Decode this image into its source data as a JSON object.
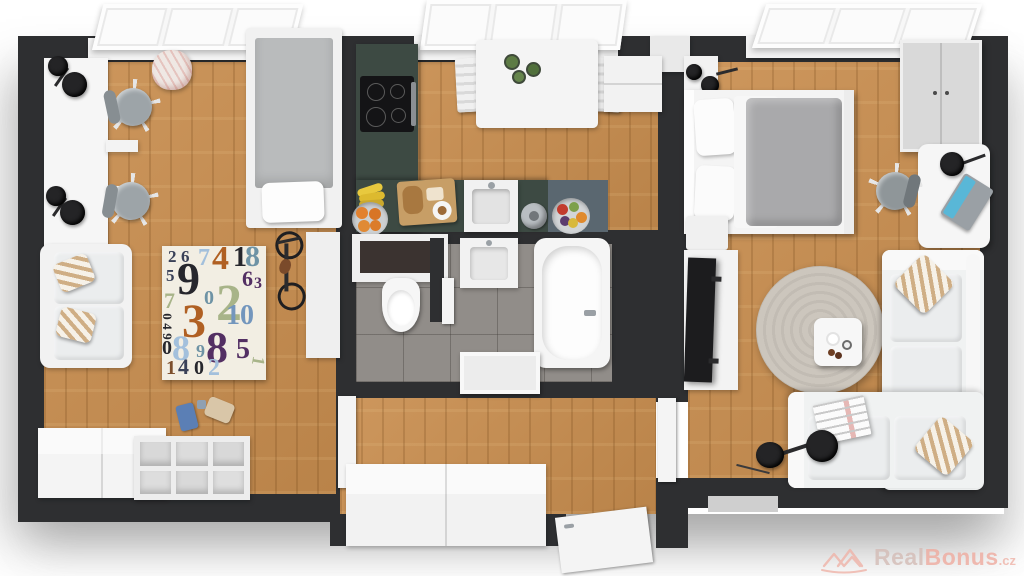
{
  "watermark": {
    "real": "Real",
    "bonus": "Bonus",
    "tld": ".cz",
    "icon": "houses-icon",
    "color_real": "#d4bcb6",
    "color_bonus": "#efab9f"
  },
  "palette": {
    "wall": "#2e2f31",
    "wood": "#c98e4f",
    "tile": "#918d89",
    "white_furniture": "#f3f3f3",
    "counter_green": "#3d4a43",
    "counter_slate": "#5a6770",
    "blanket_gray": "#a9a9ab",
    "round_rug": "#ccc6bd",
    "rugbg": "#f2eee3",
    "cooktop_black": "#141416",
    "laptop_screen": "#59b7d7",
    "orange_fruit": "#e2812f",
    "banana_yellow": "#e8c93e"
  },
  "rug": {
    "colors": {
      "navy": "#3a4158",
      "ink": "#26262c",
      "lblue": "#a3c0dc",
      "orange": "#b06023",
      "steel": "#6e93a5",
      "purple": "#532f63",
      "sage": "#a8b489",
      "blue": "#7396bd",
      "brown": "#7d4f2c"
    },
    "digits": [
      {
        "c": "2",
        "k": "navy",
        "s": 17,
        "x": 6,
        "y": 2,
        "r": 0
      },
      {
        "c": "6",
        "k": "navy",
        "s": 17,
        "x": 19,
        "y": 2,
        "r": 0
      },
      {
        "c": "7",
        "k": "lblue",
        "s": 24,
        "x": 36,
        "y": 0,
        "r": 0
      },
      {
        "c": "4",
        "k": "orange",
        "s": 34,
        "x": 50,
        "y": -4,
        "r": 0
      },
      {
        "c": "1",
        "k": "ink",
        "s": 28,
        "x": 71,
        "y": -2,
        "r": 0
      },
      {
        "c": "8",
        "k": "steel",
        "s": 30,
        "x": 83,
        "y": -4,
        "r": 0
      },
      {
        "c": "5",
        "k": "navy",
        "s": 17,
        "x": 4,
        "y": 21,
        "r": 0
      },
      {
        "c": "9",
        "k": "ink",
        "s": 46,
        "x": 15,
        "y": 10,
        "r": 0
      },
      {
        "c": "6",
        "k": "purple",
        "s": 22,
        "x": 80,
        "y": 22,
        "r": 0
      },
      {
        "c": "3",
        "k": "purple",
        "s": 16,
        "x": 92,
        "y": 30,
        "r": 0
      },
      {
        "c": "7",
        "k": "sage",
        "s": 22,
        "x": 2,
        "y": 44,
        "r": 0
      },
      {
        "c": "0",
        "k": "steel",
        "s": 20,
        "x": 42,
        "y": 42,
        "r": 0
      },
      {
        "c": "2",
        "k": "sage",
        "s": 52,
        "x": 54,
        "y": 32,
        "r": 0
      },
      {
        "c": "0",
        "k": "ink",
        "s": 13,
        "x": 2,
        "y": 64,
        "r": 90
      },
      {
        "c": "4",
        "k": "ink",
        "s": 13,
        "x": 2,
        "y": 74,
        "r": 90
      },
      {
        "c": "9",
        "k": "ink",
        "s": 13,
        "x": 2,
        "y": 84,
        "r": 90
      },
      {
        "c": "3",
        "k": "orange",
        "s": 48,
        "x": 20,
        "y": 52,
        "r": 0
      },
      {
        "c": "1",
        "k": "blue",
        "s": 28,
        "x": 64,
        "y": 56,
        "r": 0
      },
      {
        "c": "0",
        "k": "blue",
        "s": 28,
        "x": 78,
        "y": 56,
        "r": 0
      },
      {
        "c": "0",
        "k": "ink",
        "s": 20,
        "x": 0,
        "y": 92,
        "r": 0
      },
      {
        "c": "8",
        "k": "lblue",
        "s": 36,
        "x": 10,
        "y": 84,
        "r": 0
      },
      {
        "c": "9",
        "k": "steel",
        "s": 18,
        "x": 34,
        "y": 96,
        "r": 0
      },
      {
        "c": "8",
        "k": "purple",
        "s": 44,
        "x": 44,
        "y": 80,
        "r": 0
      },
      {
        "c": "5",
        "k": "purple",
        "s": 28,
        "x": 74,
        "y": 90,
        "r": 0
      },
      {
        "c": "1",
        "k": "brown",
        "s": 20,
        "x": 4,
        "y": 112,
        "r": 0
      },
      {
        "c": "4",
        "k": "navy",
        "s": 22,
        "x": 16,
        "y": 110,
        "r": 0
      },
      {
        "c": "0",
        "k": "ink",
        "s": 20,
        "x": 32,
        "y": 112,
        "r": 0
      },
      {
        "c": "2",
        "k": "lblue",
        "s": 24,
        "x": 46,
        "y": 110,
        "r": 0
      },
      {
        "c": "1",
        "k": "sage",
        "s": 18,
        "x": 92,
        "y": 106,
        "r": 100
      }
    ]
  },
  "scene": {
    "type": "3d-floor-plan-render",
    "rooms": [
      {
        "name": "kids-room-office",
        "floor": "wood",
        "items": [
          "window",
          "double-desk",
          "desk-lamps",
          "office-chair",
          "office-chair",
          "single-bed",
          "numbers-rug",
          "sofa",
          "bicycle",
          "toy-blocks",
          "storage-cabinets",
          "backpack"
        ]
      },
      {
        "name": "kitchen",
        "floor": "wood",
        "items": [
          "window",
          "cooktop-counter",
          "sink-counter",
          "dining-table",
          "dining-chairs",
          "fridge-cabinet",
          "fruit-bowl",
          "bananas",
          "cutting-board",
          "kettle"
        ]
      },
      {
        "name": "bathroom",
        "floor": "tile",
        "items": [
          "toilet",
          "wall-niche",
          "vanity-sink",
          "bathtub",
          "shower-mat",
          "wc-door"
        ]
      },
      {
        "name": "hallway",
        "floor": "wood",
        "items": [
          "wardrobe-cabinet",
          "door-left",
          "door-right",
          "entrance-door"
        ]
      },
      {
        "name": "living-bedroom",
        "floor": "wood",
        "items": [
          "window",
          "double-bed",
          "nightstand",
          "wall-lamps",
          "wardrobe",
          "desk",
          "laptop",
          "desk-lamp",
          "office-chair",
          "tv",
          "tv-bench",
          "round-rug",
          "coffee-table",
          "corner-sofa",
          "striped-pillows",
          "magazine",
          "floor-lamp",
          "doormat"
        ]
      }
    ]
  }
}
